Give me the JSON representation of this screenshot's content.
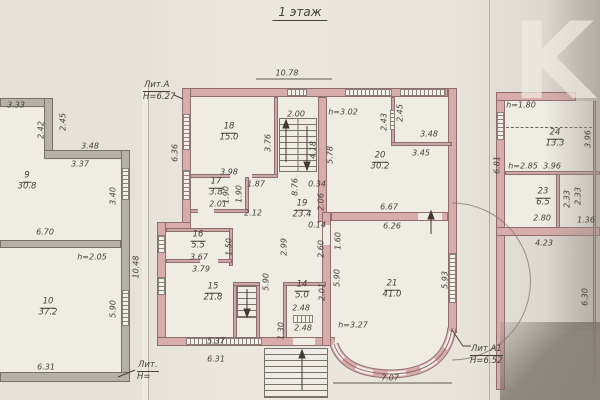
{
  "title": "1 этаж",
  "watermark": "K",
  "colors": {
    "wall_masonry": "#d8acaa",
    "wall_gray": "#b5b1aa",
    "paper": "#e8e3da",
    "ink": "#46403a"
  },
  "labels": {
    "lit_a": "Лит.А",
    "lit_a_h": "H=6.27",
    "lit_a1": "Лит А1",
    "lit_a1_h": "H=6.52",
    "lit_left": "Лит.",
    "lit_left_h": "H="
  },
  "notes": {
    "h302": "h=3.02",
    "h327": "h=3.27",
    "h205": "h=2.05",
    "h180": "h=1.80",
    "h285": "h=2.85"
  },
  "rooms": {
    "r9": {
      "num": "9",
      "area": "30.8"
    },
    "r10": {
      "num": "10",
      "area": "37.2"
    },
    "r14": {
      "num": "14",
      "area": "5.0"
    },
    "r15": {
      "num": "15",
      "area": "21.8"
    },
    "r16": {
      "num": "16",
      "area": "5.5"
    },
    "r17": {
      "num": "17",
      "area": "3.8"
    },
    "r18": {
      "num": "18",
      "area": "15.0"
    },
    "r19": {
      "num": "19",
      "area": "23.4"
    },
    "r20": {
      "num": "20",
      "area": "30.2"
    },
    "r21": {
      "num": "21",
      "area": "41.0"
    },
    "r23": {
      "num": "23",
      "area": "6.5"
    },
    "r24": {
      "num": "24",
      "area": "13.3"
    }
  },
  "dims": {
    "c_top": "10.78",
    "c_stairw": "2.00",
    "c_376": "3.76",
    "c_636": "6.36",
    "c_398": "3.98",
    "c_187": "1.87",
    "c_418": "4.18",
    "c_578": "5.78",
    "c_243": "2.43",
    "c_245": "2.45",
    "c_348": "3.48",
    "c_345": "3.45",
    "c_190a": "1.90",
    "c_190b": "1.90",
    "c_201a": "2.01",
    "c_876": "8.76",
    "c_212": "2.12",
    "c_034": "0.34",
    "c_206": "2.06",
    "c_014": "0.14",
    "c_160": "1.60",
    "c_299": "2.99",
    "c_150": "1.50",
    "c_367": "3.67",
    "c_379": "3.79",
    "c_537": "5.37",
    "c_631": "6.31",
    "c_667": "6.67",
    "c_626": "6.26",
    "c_590a": "5.90",
    "c_590b": "5.90",
    "c_593": "5.93",
    "c_260": "2.60",
    "c_201b": "2.01",
    "c_248a": "2.48",
    "c_248b": "2.48",
    "c_130": "1.30",
    "c_707": "7.07",
    "l_333": "3.33",
    "l_242": "2.42",
    "l_245": "2.45",
    "l_348": "3.48",
    "l_337": "3.37",
    "l_340": "3.40",
    "l_670": "6.70",
    "l_1048": "10.48",
    "l_590": "5.90",
    "l_631": "6.31",
    "r_396a": "3.96",
    "r_396b": "3.96",
    "r_233a": "2.33",
    "r_233b": "2.33",
    "r_280": "2.80",
    "r_136": "1.36",
    "r_681": "6.81",
    "r_423": "4.23",
    "r_630": "6.30"
  }
}
